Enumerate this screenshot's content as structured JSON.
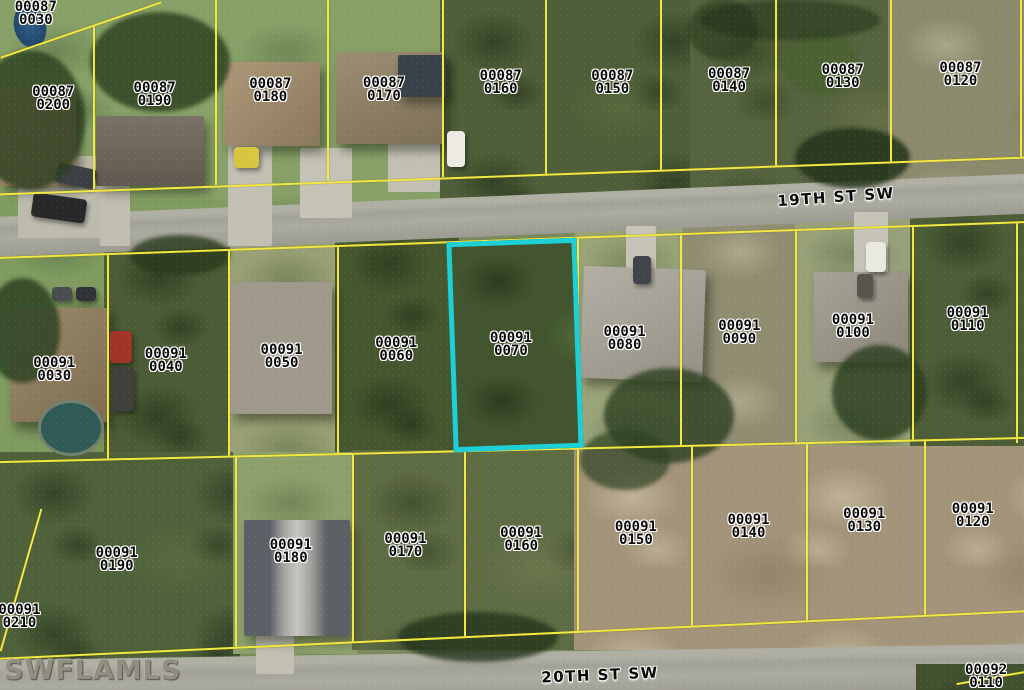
{
  "map": {
    "type": "aerial-parcel-map",
    "watermark": "SWFLAMLS",
    "parcel_line_color": "#f2e843",
    "highlight": {
      "block": "00091",
      "lot": "0070",
      "color": "#1dd0d6"
    },
    "streets": [
      {
        "name": "19TH ST SW",
        "x_pct": 81.6,
        "y_pct": 28.6,
        "rotation_deg": -4
      },
      {
        "name": "20TH ST SW",
        "x_pct": 58.6,
        "y_pct": 97.8,
        "rotation_deg": -2.5
      }
    ],
    "parcels": [
      {
        "block": "00087",
        "lot": "0030",
        "x_pct": 3.5,
        "y_pct": 2.0
      },
      {
        "block": "00087",
        "lot": "0200",
        "x_pct": 5.2,
        "y_pct": 14.3
      },
      {
        "block": "00087",
        "lot": "0190",
        "x_pct": 15.1,
        "y_pct": 13.8
      },
      {
        "block": "00087",
        "lot": "0180",
        "x_pct": 26.4,
        "y_pct": 13.2
      },
      {
        "block": "00087",
        "lot": "0170",
        "x_pct": 37.5,
        "y_pct": 13.0
      },
      {
        "block": "00087",
        "lot": "0160",
        "x_pct": 48.9,
        "y_pct": 12.0
      },
      {
        "block": "00087",
        "lot": "0150",
        "x_pct": 59.8,
        "y_pct": 12.0
      },
      {
        "block": "00087",
        "lot": "0140",
        "x_pct": 71.2,
        "y_pct": 11.7
      },
      {
        "block": "00087",
        "lot": "0130",
        "x_pct": 82.3,
        "y_pct": 11.2
      },
      {
        "block": "00087",
        "lot": "0120",
        "x_pct": 93.8,
        "y_pct": 10.9
      },
      {
        "block": "00091",
        "lot": "0030",
        "x_pct": 5.3,
        "y_pct": 53.6
      },
      {
        "block": "00091",
        "lot": "0040",
        "x_pct": 16.2,
        "y_pct": 52.3
      },
      {
        "block": "00091",
        "lot": "0050",
        "x_pct": 27.5,
        "y_pct": 51.7
      },
      {
        "block": "00091",
        "lot": "0060",
        "x_pct": 38.7,
        "y_pct": 50.7
      },
      {
        "block": "00091",
        "lot": "0070",
        "x_pct": 49.9,
        "y_pct": 50.0
      },
      {
        "block": "00091",
        "lot": "0080",
        "x_pct": 61.0,
        "y_pct": 49.1
      },
      {
        "block": "00091",
        "lot": "0090",
        "x_pct": 72.2,
        "y_pct": 48.3
      },
      {
        "block": "00091",
        "lot": "0100",
        "x_pct": 83.3,
        "y_pct": 47.4
      },
      {
        "block": "00091",
        "lot": "0110",
        "x_pct": 94.5,
        "y_pct": 46.4
      },
      {
        "block": "00091",
        "lot": "0190",
        "x_pct": 11.4,
        "y_pct": 81.2
      },
      {
        "block": "00091",
        "lot": "0210",
        "x_pct": 1.9,
        "y_pct": 89.4
      },
      {
        "block": "00091",
        "lot": "0180",
        "x_pct": 28.4,
        "y_pct": 80.0
      },
      {
        "block": "00091",
        "lot": "0170",
        "x_pct": 39.6,
        "y_pct": 79.1
      },
      {
        "block": "00091",
        "lot": "0160",
        "x_pct": 50.9,
        "y_pct": 78.3
      },
      {
        "block": "00091",
        "lot": "0150",
        "x_pct": 62.1,
        "y_pct": 77.4
      },
      {
        "block": "00091",
        "lot": "0140",
        "x_pct": 73.1,
        "y_pct": 76.4
      },
      {
        "block": "00091",
        "lot": "0130",
        "x_pct": 84.4,
        "y_pct": 75.5
      },
      {
        "block": "00091",
        "lot": "0120",
        "x_pct": 95.0,
        "y_pct": 74.8
      },
      {
        "block": "00092",
        "lot": "0110",
        "x_pct": 96.3,
        "y_pct": 98.1
      }
    ]
  }
}
